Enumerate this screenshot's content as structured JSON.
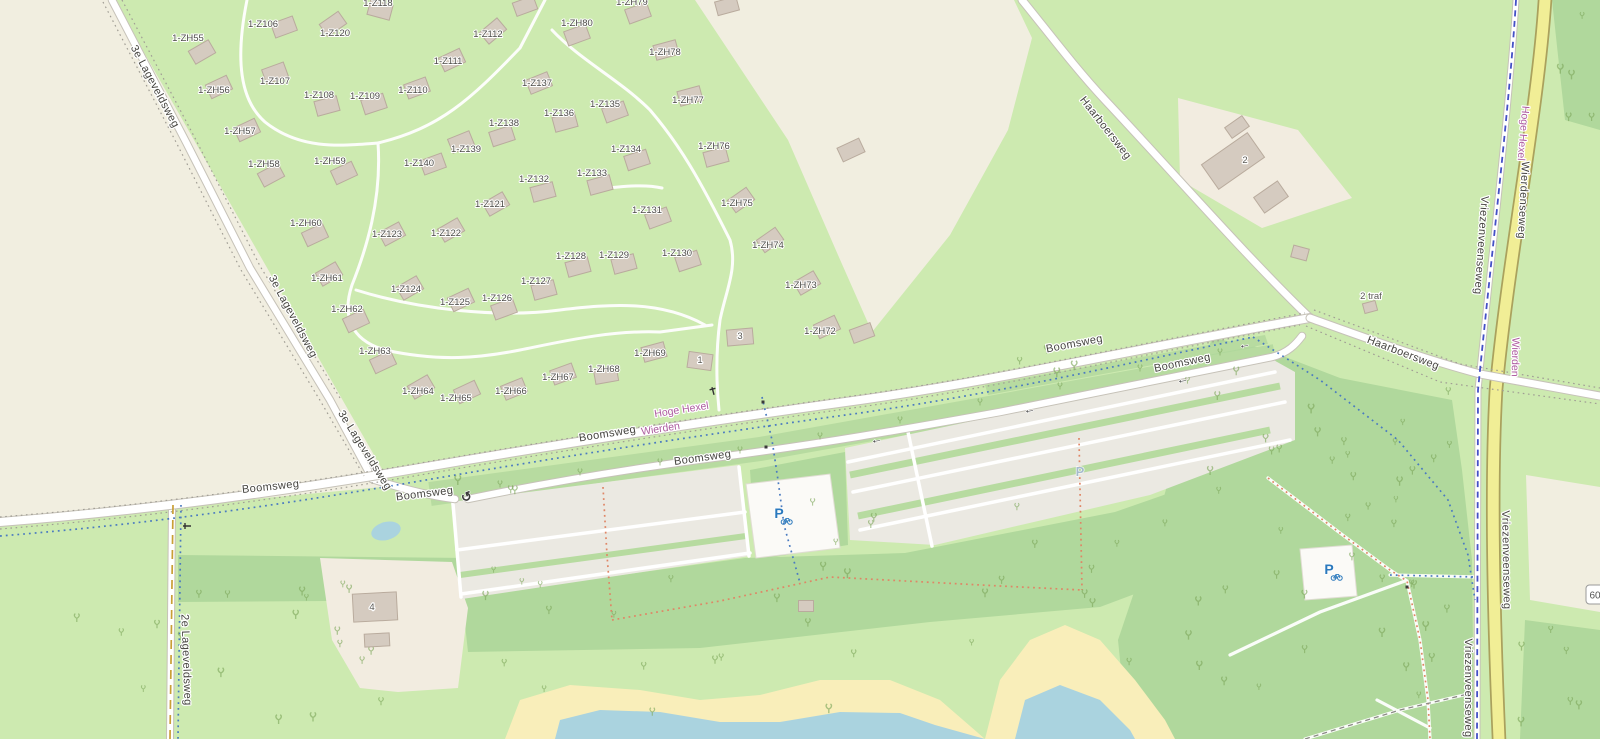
{
  "map": {
    "colors": {
      "grass": "#cdeab0",
      "scrub": "#b7dba0",
      "woods": "#b0d89c",
      "farmland": "#f1eee0",
      "farmyard": "#f2ece0",
      "sand": "#f9eeba",
      "water": "#aad3df",
      "building": "#d5cbc0",
      "building_stroke": "#b9ab9d",
      "road_fill": "#ffffff",
      "road_casing": "#c6c2b8",
      "yellow_road": "#f1ee96",
      "yellow_casing": "#aaa15d",
      "parking": "#ebe9e2",
      "cycle_route": "#4450c6",
      "cycle_dots": "#4a7ac0",
      "foot_dots": "#df8666",
      "track_dash": "#c99f35",
      "place_label": "#ad5c9f",
      "p_blue": "#2b79bd",
      "p_gray": "#a5bbcb"
    },
    "street_labels": [
      {
        "text": "3e Lageveldsweg",
        "x": 152,
        "y": 88,
        "rot": 62
      },
      {
        "text": "3e Lageveldsweg",
        "x": 290,
        "y": 318,
        "rot": 62
      },
      {
        "text": "3e Lageveldsweg",
        "x": 362,
        "y": 452,
        "rot": 58
      },
      {
        "text": "2e Lageveldsweg",
        "x": 183,
        "y": 660,
        "rot": 88
      },
      {
        "text": "Boomsweg",
        "x": 271,
        "y": 490,
        "rot": -6
      },
      {
        "text": "Boomsweg",
        "x": 425,
        "y": 497,
        "rot": -7
      },
      {
        "text": "Boomsweg",
        "x": 608,
        "y": 437,
        "rot": -9
      },
      {
        "text": "Boomsweg",
        "x": 703,
        "y": 461,
        "rot": -8
      },
      {
        "text": "Boomsweg",
        "x": 1075,
        "y": 347,
        "rot": -11
      },
      {
        "text": "Boomsweg",
        "x": 1183,
        "y": 366,
        "rot": -12
      },
      {
        "text": "Haarboersweg",
        "x": 1103,
        "y": 130,
        "rot": 52
      },
      {
        "text": "Haarboersweg",
        "x": 1402,
        "y": 356,
        "rot": 21
      },
      {
        "text": "Wierdenseweg",
        "x": 1520,
        "y": 200,
        "rot": 93
      },
      {
        "text": "Vriezenveenseweg",
        "x": 1478,
        "y": 245,
        "rot": 94
      },
      {
        "text": "Vriezenveenseweg",
        "x": 1503,
        "y": 560,
        "rot": 89
      },
      {
        "text": "Vriezenveenseweg",
        "x": 1465,
        "y": 688,
        "rot": 90
      }
    ],
    "place_labels": [
      {
        "text": "Hoge Hexel",
        "x": 682,
        "y": 413,
        "rot": -9
      },
      {
        "text": "Wierden",
        "x": 661,
        "y": 432,
        "rot": -9
      },
      {
        "text": "Hoge Hexel",
        "x": 1520,
        "y": 133,
        "rot": 95
      },
      {
        "text": "Wierden",
        "x": 1512,
        "y": 357,
        "rot": 91
      }
    ],
    "misc_labels": [
      {
        "text": "2 traf",
        "x": 1371,
        "y": 296
      }
    ],
    "speed_badge": {
      "text": "60"
    },
    "cabins": [
      {
        "label": "1-ZH55",
        "lx": 188,
        "ly": 38,
        "bx": 202,
        "by": 52,
        "rot": -30
      },
      {
        "label": "1-Z106",
        "lx": 263,
        "ly": 24,
        "bx": 284,
        "by": 27,
        "rot": -20
      },
      {
        "label": "1-Z118",
        "lx": 378,
        "ly": 3,
        "bx": 380,
        "by": 10,
        "rot": 15
      },
      {
        "label": "1-Z120",
        "lx": 335,
        "ly": 33,
        "bx": 333,
        "by": 24,
        "rot": -35
      },
      {
        "label": "1-Z112",
        "lx": 488,
        "ly": 34,
        "bx": 493,
        "by": 31,
        "rot": -40
      },
      {
        "label": "1-ZH80",
        "lx": 577,
        "ly": 23,
        "bx": 577,
        "by": 35,
        "rot": -20
      },
      {
        "label": "1-ZH79",
        "lx": 632,
        "ly": 2,
        "bx": 638,
        "by": 13,
        "rot": -20
      },
      {
        "label": "1-ZH78",
        "lx": 665,
        "ly": 52,
        "bx": 666,
        "by": 50,
        "rot": -15
      },
      {
        "label": "1-ZH77",
        "lx": 688,
        "ly": 100,
        "bx": 690,
        "by": 96,
        "rot": -15
      },
      {
        "label": "1-Z111",
        "lx": 448,
        "ly": 61,
        "bx": 452,
        "by": 60,
        "rot": -25
      },
      {
        "label": "1-Z107",
        "lx": 275,
        "ly": 81,
        "bx": 275,
        "by": 73,
        "rot": -20
      },
      {
        "label": "1-ZH56",
        "lx": 214,
        "ly": 90,
        "bx": 219,
        "by": 87,
        "rot": -25
      },
      {
        "label": "1-Z110",
        "lx": 413,
        "ly": 90,
        "bx": 417,
        "by": 88,
        "rot": -20
      },
      {
        "label": "1-Z108",
        "lx": 319,
        "ly": 95,
        "bx": 327,
        "by": 106,
        "rot": -15
      },
      {
        "label": "1-Z109",
        "lx": 365,
        "ly": 96,
        "bx": 374,
        "by": 104,
        "rot": -18
      },
      {
        "label": "1-Z137",
        "lx": 537,
        "ly": 83,
        "bx": 539,
        "by": 83,
        "rot": -22
      },
      {
        "label": "1-Z135",
        "lx": 605,
        "ly": 104,
        "bx": 615,
        "by": 112,
        "rot": -20
      },
      {
        "label": "1-Z136",
        "lx": 559,
        "ly": 113,
        "bx": 565,
        "by": 122,
        "rot": -15
      },
      {
        "label": "1-Z138",
        "lx": 504,
        "ly": 123,
        "bx": 502,
        "by": 136,
        "rot": -18
      },
      {
        "label": "1-Z139",
        "lx": 466,
        "ly": 149,
        "bx": 461,
        "by": 142,
        "rot": -22
      },
      {
        "label": "1-ZH57",
        "lx": 240,
        "ly": 131,
        "bx": 247,
        "by": 130,
        "rot": -25
      },
      {
        "label": "1-ZH58",
        "lx": 264,
        "ly": 164,
        "bx": 271,
        "by": 175,
        "rot": -28
      },
      {
        "label": "1-ZH59",
        "lx": 330,
        "ly": 161,
        "bx": 344,
        "by": 173,
        "rot": -25
      },
      {
        "label": "1-Z140",
        "lx": 419,
        "ly": 163,
        "bx": 433,
        "by": 164,
        "rot": -20
      },
      {
        "label": "1-Z134",
        "lx": 626,
        "ly": 149,
        "bx": 637,
        "by": 160,
        "rot": -18
      },
      {
        "label": "1-Z133",
        "lx": 592,
        "ly": 173,
        "bx": 600,
        "by": 185,
        "rot": -15
      },
      {
        "label": "1-Z132",
        "lx": 534,
        "ly": 179,
        "bx": 543,
        "by": 192,
        "rot": -15
      },
      {
        "label": "1-ZH76",
        "lx": 714,
        "ly": 146,
        "bx": 716,
        "by": 157,
        "rot": -15
      },
      {
        "label": "1-ZH75",
        "lx": 737,
        "ly": 203,
        "bx": 741,
        "by": 200,
        "rot": -35
      },
      {
        "label": "1-ZH74",
        "lx": 768,
        "ly": 245,
        "bx": 770,
        "by": 240,
        "rot": -35
      },
      {
        "label": "1-Z131",
        "lx": 647,
        "ly": 210,
        "bx": 658,
        "by": 218,
        "rot": -20
      },
      {
        "label": "1-Z121",
        "lx": 490,
        "ly": 204,
        "bx": 496,
        "by": 204,
        "rot": -30
      },
      {
        "label": "1-Z122",
        "lx": 446,
        "ly": 233,
        "bx": 451,
        "by": 230,
        "rot": -30
      },
      {
        "label": "1-Z123",
        "lx": 387,
        "ly": 234,
        "bx": 392,
        "by": 234,
        "rot": -28
      },
      {
        "label": "1-ZH60",
        "lx": 306,
        "ly": 223,
        "bx": 315,
        "by": 235,
        "rot": -25
      },
      {
        "label": "1-Z128",
        "lx": 571,
        "ly": 256,
        "bx": 578,
        "by": 267,
        "rot": -15
      },
      {
        "label": "1-Z129",
        "lx": 614,
        "ly": 255,
        "bx": 624,
        "by": 264,
        "rot": -15
      },
      {
        "label": "1-Z130",
        "lx": 677,
        "ly": 253,
        "bx": 688,
        "by": 261,
        "rot": -18
      },
      {
        "label": "1-ZH61",
        "lx": 327,
        "ly": 278,
        "bx": 329,
        "by": 274,
        "rot": -30
      },
      {
        "label": "1-Z124",
        "lx": 406,
        "ly": 289,
        "bx": 410,
        "by": 288,
        "rot": -30
      },
      {
        "label": "1-Z125",
        "lx": 455,
        "ly": 302,
        "bx": 461,
        "by": 300,
        "rot": -25
      },
      {
        "label": "1-Z126",
        "lx": 497,
        "ly": 298,
        "bx": 504,
        "by": 309,
        "rot": -20
      },
      {
        "label": "1-Z127",
        "lx": 536,
        "ly": 281,
        "bx": 544,
        "by": 290,
        "rot": -15
      },
      {
        "label": "1-ZH62",
        "lx": 347,
        "ly": 309,
        "bx": 356,
        "by": 321,
        "rot": -25
      },
      {
        "label": "1-ZH73",
        "lx": 801,
        "ly": 285,
        "bx": 807,
        "by": 283,
        "rot": -30
      },
      {
        "label": "1-ZH72",
        "lx": 820,
        "ly": 331,
        "bx": 827,
        "by": 327,
        "rot": -25
      },
      {
        "label": "1-ZH63",
        "lx": 375,
        "ly": 351,
        "bx": 383,
        "by": 362,
        "rot": -25
      },
      {
        "label": "1-ZH64",
        "lx": 418,
        "ly": 391,
        "bx": 421,
        "by": 387,
        "rot": -30
      },
      {
        "label": "1-ZH65",
        "lx": 456,
        "ly": 398,
        "bx": 467,
        "by": 392,
        "rot": -25
      },
      {
        "label": "1-ZH66",
        "lx": 511,
        "ly": 391,
        "bx": 514,
        "by": 389,
        "rot": -22
      },
      {
        "label": "1-ZH67",
        "lx": 558,
        "ly": 377,
        "bx": 563,
        "by": 374,
        "rot": -20
      },
      {
        "label": "1-ZH68",
        "lx": 604,
        "ly": 369,
        "bx": 606,
        "by": 375,
        "rot": -10
      },
      {
        "label": "1-ZH69",
        "lx": 650,
        "ly": 353,
        "bx": 654,
        "by": 352,
        "rot": -15
      }
    ],
    "buildings": [
      {
        "label": "2",
        "x": 1233,
        "y": 161,
        "w": 56,
        "h": 30,
        "rot": -35,
        "lx": 1245,
        "ly": 160
      },
      {
        "x": 1237,
        "y": 127,
        "w": 21,
        "h": 13,
        "rot": -35
      },
      {
        "x": 1271,
        "y": 197,
        "w": 29,
        "h": 19,
        "rot": -35
      },
      {
        "x": 1300,
        "y": 253,
        "w": 16,
        "h": 12,
        "rot": 15
      },
      {
        "x": 1370,
        "y": 307,
        "w": 13,
        "h": 10,
        "rot": -15
      },
      {
        "label": "3",
        "x": 740,
        "y": 337,
        "w": 26,
        "h": 16,
        "rot": -5,
        "lx": 740,
        "ly": 336
      },
      {
        "label": "1",
        "x": 700,
        "y": 361,
        "w": 24,
        "h": 16,
        "rot": 8,
        "lx": 700,
        "ly": 360
      },
      {
        "label": "4",
        "x": 375,
        "y": 607,
        "w": 44,
        "h": 28,
        "rot": -3,
        "lx": 372,
        "ly": 607
      },
      {
        "x": 377,
        "y": 640,
        "w": 25,
        "h": 13,
        "rot": -3
      },
      {
        "x": 806,
        "y": 606,
        "w": 15,
        "h": 11,
        "rot": 0
      },
      {
        "x": 525,
        "y": 6,
        "w": 22,
        "h": 14,
        "rot": -20
      },
      {
        "x": 727,
        "y": 6,
        "w": 22,
        "h": 14,
        "rot": -15
      },
      {
        "x": 851,
        "y": 150,
        "w": 24,
        "h": 15,
        "rot": -25
      },
      {
        "x": 862,
        "y": 333,
        "w": 22,
        "h": 14,
        "rot": -20
      }
    ],
    "icons": {
      "bicycle_parking": [
        {
          "x": 779,
          "y": 514
        },
        {
          "x": 1329,
          "y": 570
        }
      ],
      "car_parking": {
        "x": 1080,
        "y": 472
      },
      "turning_circle": {
        "x": 468,
        "y": 497
      },
      "oneway_arrows": [
        {
          "x": 877,
          "y": 439,
          "rot": -10
        },
        {
          "x": 1030,
          "y": 409,
          "rot": -11
        },
        {
          "x": 1183,
          "y": 379,
          "rot": -11
        },
        {
          "x": 1245,
          "y": 344,
          "rot": -10
        }
      ],
      "gates": [
        {
          "x": 713,
          "y": 391,
          "rot": 75
        },
        {
          "x": 187,
          "y": 526,
          "rot": 0
        }
      ],
      "crossing_marks": [
        {
          "x": 763,
          "y": 402
        },
        {
          "x": 766,
          "y": 447
        },
        {
          "x": 1407,
          "y": 587
        }
      ]
    }
  }
}
